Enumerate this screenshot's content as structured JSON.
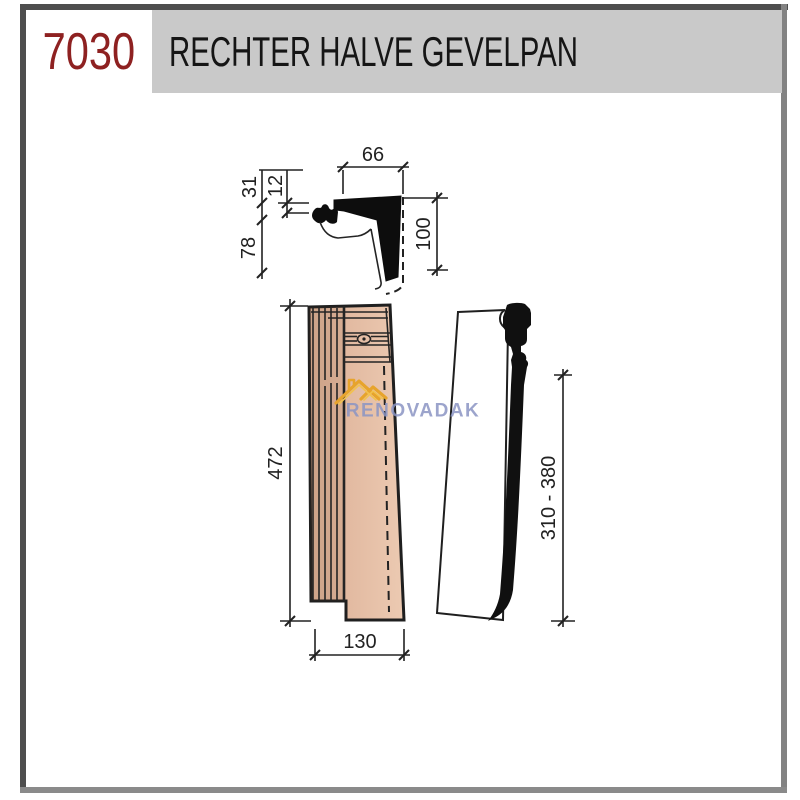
{
  "header": {
    "product_code": "7030",
    "title": "RECHTER HALVE GEVELPAN",
    "colors": {
      "code_text": "#8e2121",
      "title_text": "#151515",
      "bar_bg": "#c9c9c9",
      "frame": "#4e4e4e"
    }
  },
  "drawing": {
    "cross_section": {
      "dims": {
        "top_width": "66",
        "upper_left": "31",
        "thickness": "12",
        "lower_left": "78",
        "right_height": "100"
      }
    },
    "top_view": {
      "dims": {
        "length": "472",
        "width": "130"
      }
    },
    "side_view": {
      "dims": {
        "batten_range": "310 - 380"
      }
    },
    "line_color": "#222222",
    "tile_colors": {
      "light": "#eccab2",
      "mid": "#e3bba2",
      "dark": "#d8ad93"
    }
  },
  "watermark": {
    "text": "RENOVADAK",
    "text_color": "#8b95c4",
    "logo_color_main": "#e7a42c",
    "logo_color_light": "#f2c24d"
  }
}
